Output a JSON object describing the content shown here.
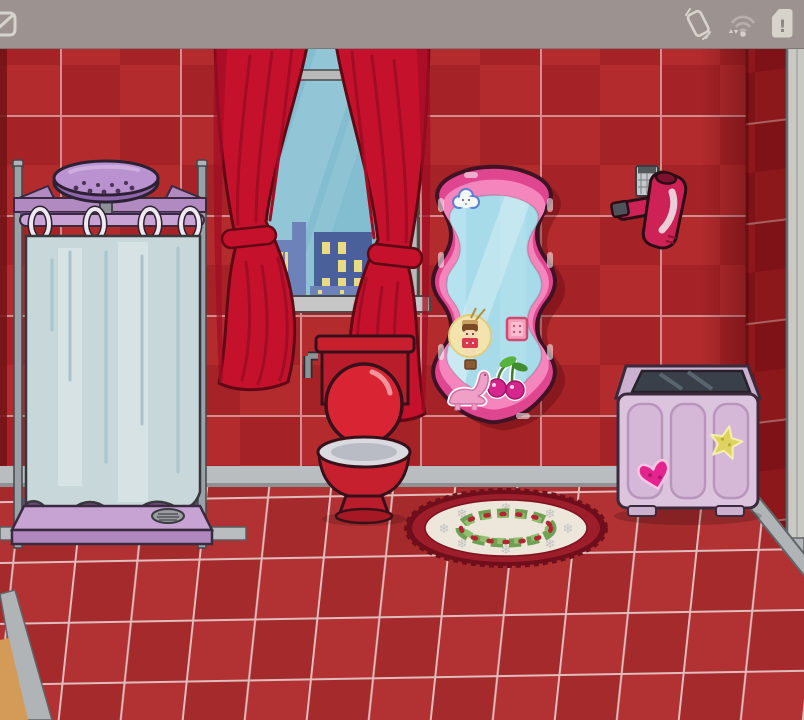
{
  "status_bar": {
    "background": "#9c9390",
    "left_icon": "notification-partial-icon",
    "right_icons": [
      "screen-rotation-icon",
      "wifi-data-icon",
      "sim-card-alert-icon"
    ],
    "sim_alert_glyph": "!"
  },
  "scene": {
    "objects": [
      "shower",
      "window",
      "curtain-left",
      "curtain-right",
      "toilet",
      "wavy-mirror",
      "cloud-sticker",
      "doll-sticker",
      "square-sticker",
      "cherries-sticker",
      "dinosaur-sticker",
      "hair-dryer",
      "washing-machine",
      "heart-sticker",
      "star-sticker",
      "wreath-rug"
    ]
  },
  "rug": {
    "snowflake_glyph": "❄"
  },
  "colors": {
    "statusbar_bg": "#9c9390",
    "icon_gray": "#d8d2cd",
    "wall_a": "#b32b2d",
    "wall_b": "#a52327",
    "wall_grout": "#cf8f8f",
    "side_a": "#8d181c",
    "side_b": "#7e1216",
    "side_grout": "#a85f60",
    "floor_a": "#b23133",
    "floor_b": "#a42a2c",
    "floor_grout": "#e0bcbc",
    "baseboard": "#babdbf",
    "baseboard_edge": "#8e9194",
    "corner_gray": "#b0b4b6",
    "tan_floor": "#d49a58",
    "left_shadow": "#701317",
    "right_strip": "#c9c9c3",
    "curtain_red": "#c6112c",
    "curtain_fold": "#a10d24",
    "curtain_outline": "#5f0915",
    "sky": "#82bdd0",
    "building_a": "#6d82b8",
    "building_b": "#49609b",
    "window_glow": "#ead985",
    "frame_gray": "#b9b9b9",
    "sill_gray": "#c6c6c6",
    "metal_gray": "#9aa1a7",
    "purple_board": "#b28ac2",
    "purple_head": "#ba92d0",
    "purple_head_under": "#9066ac",
    "purple_rod": "#c9a2d6",
    "tray_top": "#c7a3d4",
    "tray_front": "#b087bf",
    "shower_curtain": "#c7d7da",
    "shower_curtain_streak": "#a9c4cc",
    "shower_curtain_light": "#d8e3e5",
    "toilet_red": "#c6202f",
    "toilet_red_dark": "#b91c2b",
    "seat_red": "#d92433",
    "porcelain": "#dadbe0",
    "porcelain_shadow": "#b9bcc4",
    "outline_dark": "#38101a",
    "mirror_frame": "#e0458f",
    "mirror_frame_light": "#f585bd",
    "mirror_glass": "#a7dbe9",
    "washer_body": "#dcc3de",
    "washer_panel": "#d5b8d8",
    "washer_frame": "#cbb0cf",
    "washer_glass": "#3a4049",
    "heart_pink": "#e5238f",
    "star_yellow": "#ddd35e",
    "dryer_pink": "#ce2257",
    "dryer_dark": "#4e525a",
    "rug_border": "#9e1d2a",
    "rug_border_dark": "#6e0f1b",
    "rug_cream": "#ece7da",
    "snowflake_gray": "#c3c3c3",
    "holly_dark": "#6fa053",
    "holly_light": "#8fbf6f",
    "berry_red": "#b52430"
  }
}
